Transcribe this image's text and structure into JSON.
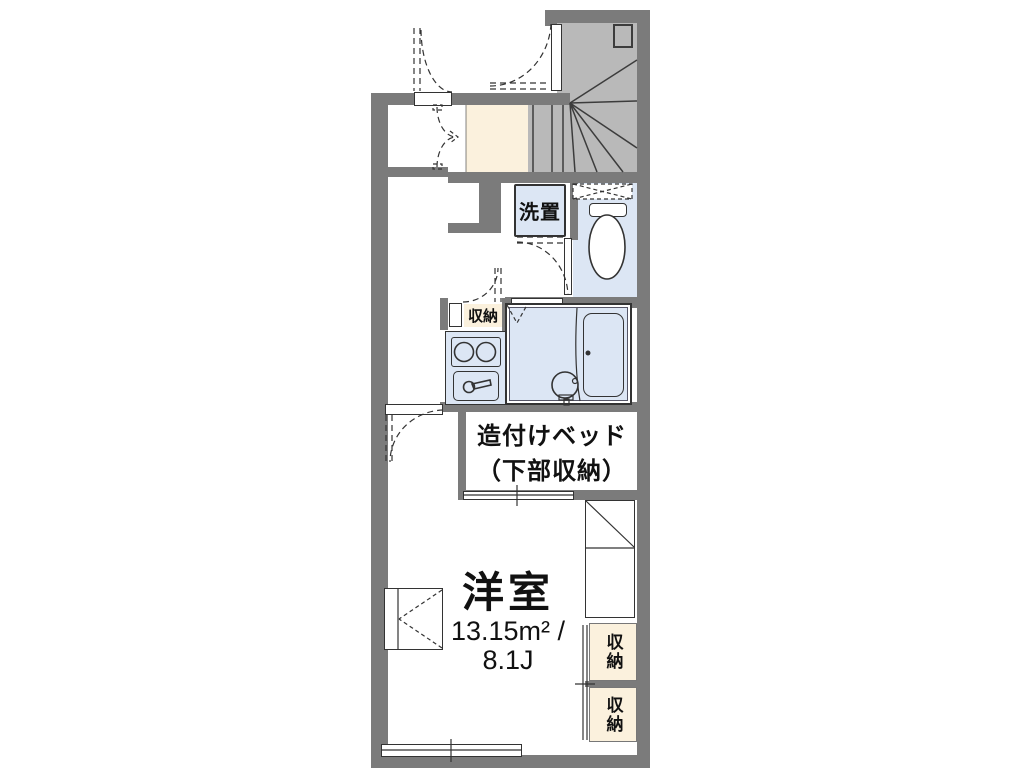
{
  "labels": {
    "main_room": {
      "name": "洋室",
      "area_m2": "13.15m² /",
      "area_jo": "8.1J"
    },
    "bed": {
      "line1": "造付けベッド",
      "line2": "（下部収納）"
    },
    "washer": "洗置",
    "kitchen_storage": "収納",
    "storage_upper": "収納",
    "storage_lower": "収納"
  },
  "colors": {
    "wall": "#7b7b7b",
    "stair": "#b9b9b9",
    "stairline": "#3c3c3c",
    "cream": "#fbf1dd",
    "blue": "#dce6f4",
    "line": "#333333",
    "text": "#111111"
  }
}
